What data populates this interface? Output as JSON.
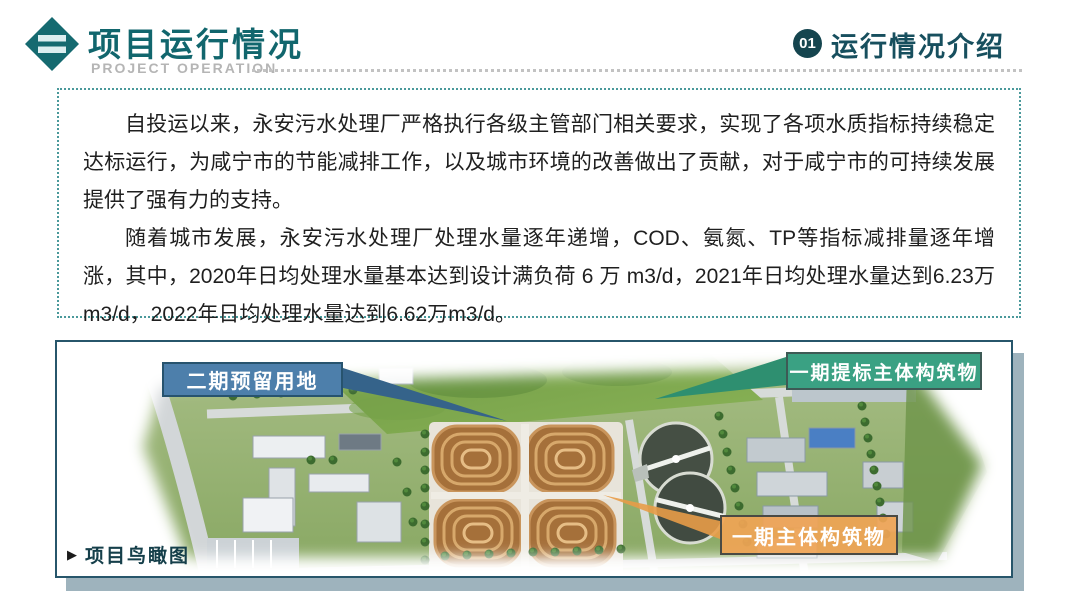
{
  "header": {
    "title": "项目运行情况",
    "subtitle": "PROJECT OPERATION",
    "section_badge": "01",
    "section_title": "运行情况介绍"
  },
  "intro": {
    "paragraph1": "自投运以来，永安污水处理厂严格执行各级主管部门相关要求，实现了各项水质指标持续稳定达标运行，为咸宁市的节能减排工作，以及城市环境的改善做出了贡献，对于咸宁市的可持续发展提供了强有力的支持。",
    "paragraph2": "随着城市发展，永安污水处理厂处理水量逐年递增，COD、氨氮、TP等指标减排量逐年增涨，其中，2020年日均处理水量基本达到设计满负荷 6 万 m3/d，2021年日均处理水量达到6.23万 m3/d，2022年日均处理水量达到6.62万m3/d。"
  },
  "aerial": {
    "caption": "项目鸟瞰图",
    "labels": {
      "phase2_reserved": "二期预留用地",
      "phase1_upgrade": "一期提标主体构筑物",
      "phase1_main": "一期主体构筑物"
    }
  },
  "colors": {
    "theme_teal": "#11666d",
    "section_dark_teal": "#174f5e",
    "dashed_border_teal": "#4a999b",
    "panel_border_navy": "#27566b",
    "panel_shadow": "#9eb3bd",
    "label_blue": "#4d7fab",
    "label_green": "#3aa183",
    "label_orange": "#f0a455",
    "subtitle_gray": "#b5b5b5"
  }
}
